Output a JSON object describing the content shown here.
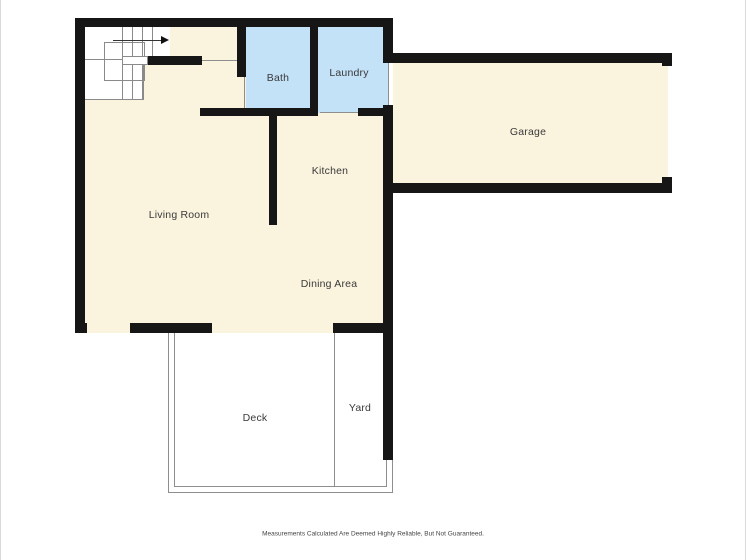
{
  "floorplan": {
    "rooms": {
      "bath": {
        "label": "Bath",
        "fill": "#c3e1f7"
      },
      "laundry": {
        "label": "Laundry",
        "fill": "#c3e1f7"
      },
      "garage": {
        "label": "Garage",
        "fill": "#faf3dd"
      },
      "kitchen": {
        "label": "Kitchen",
        "fill": "#faf3dd"
      },
      "living_room": {
        "label": "Living Room",
        "fill": "#faf3dd"
      },
      "dining_area": {
        "label": "Dining Area",
        "fill": "#faf3dd"
      },
      "deck": {
        "label": "Deck",
        "fill": "#ffffff"
      },
      "yard": {
        "label": "Yard",
        "fill": "#ffffff"
      }
    },
    "colors": {
      "wall": "#161616",
      "room_cream": "#faf3dd",
      "room_blue": "#c3e1f7",
      "thin_line": "#8a8a8a",
      "label_text": "#3a3a3a",
      "background": "#ffffff"
    },
    "stairs": {
      "direction_arrow": "right"
    }
  },
  "footer": {
    "disclaimer": "Measurements Calculated Are Deemed Highly Reliable, But Not Guaranteed."
  }
}
